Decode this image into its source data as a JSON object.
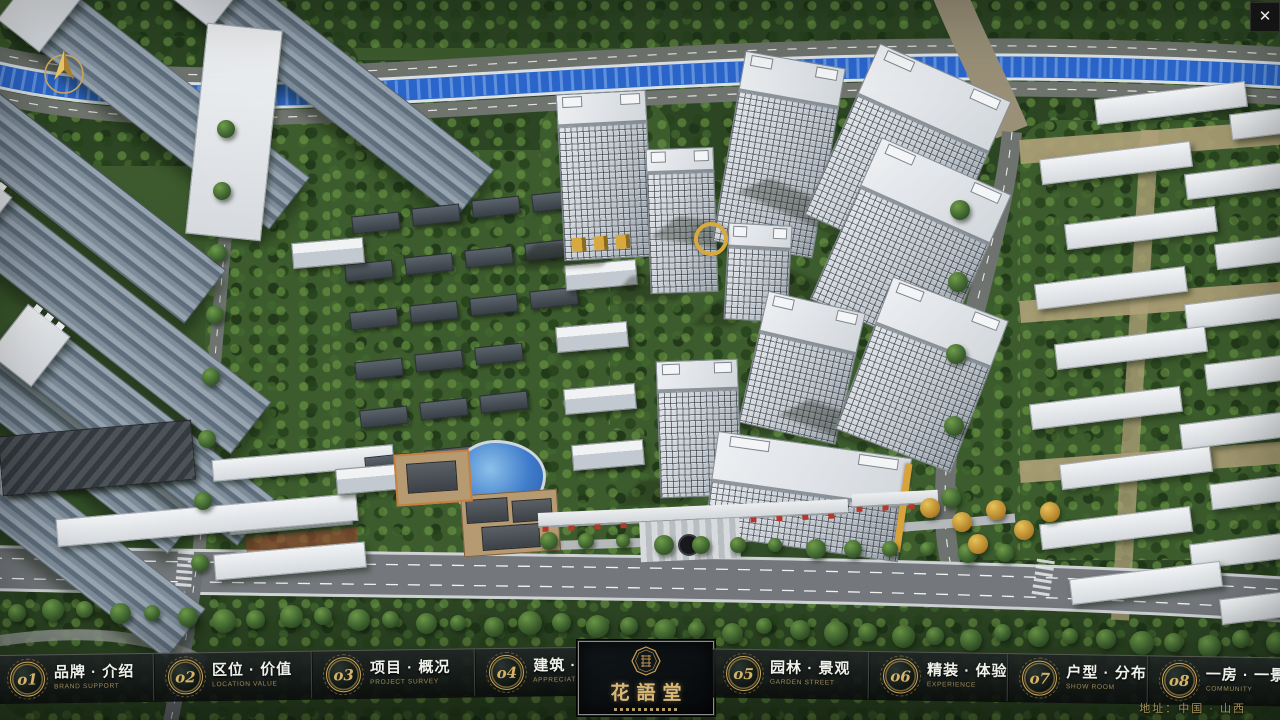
{
  "window": {
    "close_button": "✕"
  },
  "theme": {
    "gold": "#c9a458",
    "gold_dim": "#9d8a58",
    "label_white": "#eef0ea",
    "accent_red": "#b5372a",
    "river_blue": "#2b66cc"
  },
  "logo": {
    "title": "花語堂"
  },
  "menu": {
    "items": [
      {
        "num": "o1",
        "zh": "品牌 · 介绍",
        "en": "BRAND SUPPORT"
      },
      {
        "num": "o2",
        "zh": "区位 · 价值",
        "en": "LOCATION VALUE"
      },
      {
        "num": "o3",
        "zh": "项目 · 概况",
        "en": "PROJECT SURVEY"
      },
      {
        "num": "o4",
        "zh": "建筑 · 鉴赏",
        "en": "APPRECIATION"
      },
      {
        "num": "o5",
        "zh": "园林 · 景观",
        "en": "GARDEN STREET"
      },
      {
        "num": "o6",
        "zh": "精装 · 体验",
        "en": "EXPERIENCE"
      },
      {
        "num": "o7",
        "zh": "户型 · 分布",
        "en": "SHOW ROOM"
      },
      {
        "num": "o8",
        "zh": "一房 · 一景",
        "en": "COMMUNITY"
      }
    ]
  },
  "footer": {
    "address": "地址：中国 · 山西"
  }
}
